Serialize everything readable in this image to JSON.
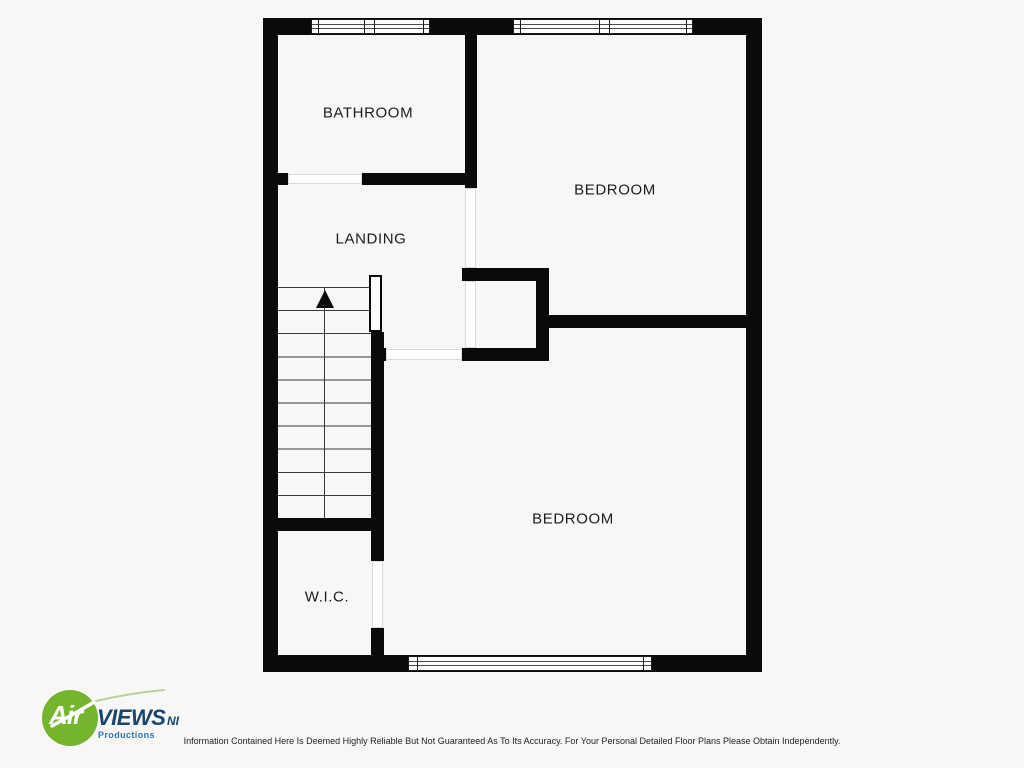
{
  "rooms": [
    {
      "id": "bathroom",
      "label": "BATHROOM"
    },
    {
      "id": "bedroom-top",
      "label": "BEDROOM"
    },
    {
      "id": "landing",
      "label": "LANDING"
    },
    {
      "id": "bedroom-bottom",
      "label": "BEDROOM"
    },
    {
      "id": "wic",
      "label": "W.I.C."
    }
  ],
  "logo": {
    "air": "Air",
    "views": "VIEWS",
    "ni": "NI",
    "productions": "Productions"
  },
  "disclaimer": "Information Contained Here Is Deemed Highly Reliable But Not Guaranteed As To Its Accuracy. For Your Personal Detailed Floor Plans Please Obtain Independently.",
  "colors": {
    "wall": "#0a0a0a",
    "background": "#f7f7f6",
    "logo_green": "#75b42d",
    "logo_dark_blue": "#17456e",
    "logo_light_blue": "#2e74b5"
  }
}
